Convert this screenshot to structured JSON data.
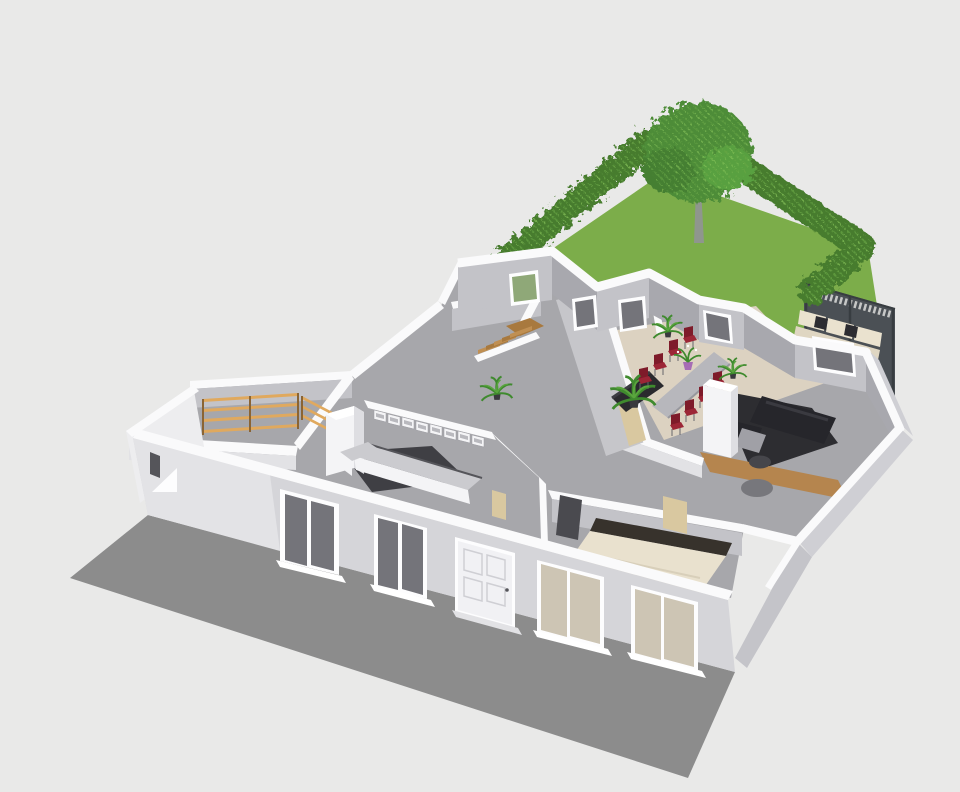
{
  "scene": {
    "type": "3d-floor-plan-render",
    "description": "Cutaway aerial 3D render of a single-storey house with furnished rooms, rear garden with hedges and tree, dark privacy fence with outdoor bench, and ground shadow on plain background",
    "rooms": [
      "storage-room",
      "hallway-with-stairs",
      "back-room-left",
      "back-room-center",
      "kitchen",
      "dining-room",
      "living-room",
      "bedroom",
      "front-hall"
    ],
    "garden": [
      "lawn",
      "left-hedge",
      "right-hedge",
      "tree",
      "privacy-fence",
      "outdoor-bench"
    ],
    "furniture": [
      "wooden-shelving-racks",
      "wooden-staircase",
      "kitchen-tall-cabinet",
      "kitchen-upper-cabinets",
      "kitchen-l-counter",
      "dining-table",
      "dining-chairs-red",
      "potted-palms",
      "table-plant-purple-pot",
      "dark-sideboard",
      "dark-sofa",
      "gray-armchair",
      "round-side-table",
      "round-floor-rug",
      "double-bed-cream",
      "chimney-column"
    ],
    "facade": [
      "window-a",
      "window-b",
      "front-door",
      "window-c",
      "window-d",
      "vent-triangle",
      "window-sills"
    ]
  },
  "palette": {
    "background": "#e9e9e8",
    "shadow": "#8c8c8c",
    "lawn": "#7cad4a",
    "hedge": "#467c2e",
    "hedge_light": "#6aa746",
    "hedge_dot": "#8cc95e",
    "tree_green": "#4d8c38",
    "tree_green_dark": "#447f31",
    "tree_green_light": "#58a040",
    "trunk": "#8f968e",
    "fence": "#4b5055",
    "fence_dark": "#383d41",
    "lattice": "#dcdcda",
    "cushion": "#eae2cf",
    "cushion_seat": "#dfd6c2",
    "pillow": "#2c2c31",
    "floor": "#a7a7ab",
    "floor_beige": "#dcd2c1",
    "rug": "#2d2d31",
    "wood": "#b5854e",
    "kitchen_floor": "#3f3f44",
    "wall_white": "#fafafb",
    "wall_face_light": "#c3c3c8",
    "wall_face_mid": "#a8a8ae",
    "wall_face_bright": "#e2e2e5",
    "divider_face": "#c6c6ca",
    "facade": "#d5d5d9",
    "facade_light": "#e3e3e6",
    "west": "#ededef",
    "right_face": "#cfcfd4",
    "bedroom_right_face": "#c4c4c9",
    "frame_white": "#fdfdfe",
    "glass": "#74747a",
    "glass_warm": "#cdc5b4",
    "glass_green": "#8fa878",
    "door_face": "#f1f1f4",
    "door_panel": "#cfcfd4",
    "handle": "#55555a",
    "sill": "#ffffff",
    "counter_top": "#cbcbcf",
    "cabinet_white": "#f4f4f6",
    "cabinet_side": "#dedee2",
    "cabinet_inner": "#b9b9be",
    "counter_edge": "#55555a",
    "shelf_wood": "#e0a95e",
    "shelf_post": "#8a6434",
    "stair_wood": "#c08f52",
    "stair_wood_dark": "#a8793e",
    "table_top": "#b7b7bc",
    "table_edge": "#97979d",
    "chair_red": "#9c2636",
    "chair_red_dark": "#7e1b2a",
    "leg_gray": "#66666c",
    "plant": "#3f8a2e",
    "plant_light": "#5aa53e",
    "pot_dark": "#3a3a3e",
    "pot_purple": "#a76cb5",
    "sofa": "#26262b",
    "sofa_seam": "#3a3a40",
    "armchair": "#a0a0a6",
    "side_table": "#46464b",
    "disc": "#77777c",
    "bed_cream": "#e9e1ce",
    "headboard": "#37322c",
    "bed_frame": "#f2f2f4",
    "sideboard": "#2a2a2e",
    "sideboard_top": "#3c3c42",
    "doorway_dark": "#4a4a4f",
    "interior_door": "#d9c8a0",
    "white": "#ffffff"
  }
}
